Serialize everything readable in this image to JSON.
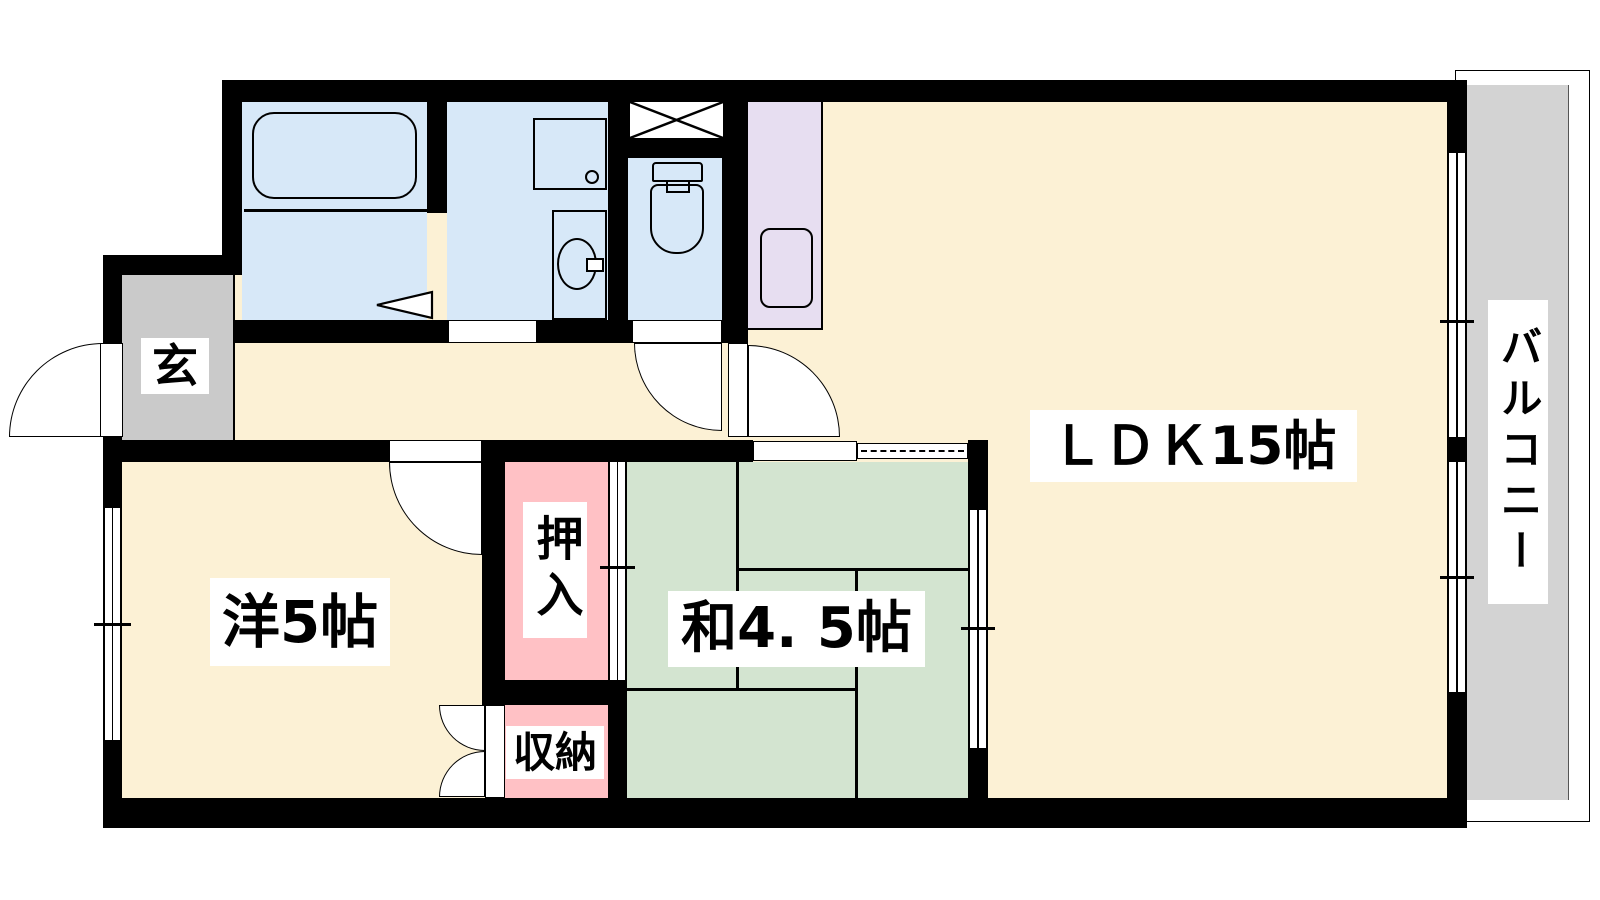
{
  "plan_type": "Japanese apartment floor plan",
  "labels": {
    "entrance": "玄",
    "western_room": "洋5帖",
    "oshiire_closet": "押入",
    "storage_closet": "収納",
    "japanese_room": "和4. 5帖",
    "ldk": "ＬＤＫ15帖",
    "balcony": "バルコニー"
  },
  "palette": {
    "wall": "#000000",
    "flooring": "#FCF1D5",
    "wet_area": "#D7E8F8",
    "kitchen_counter": "#E7DEF1",
    "closet": "#FFC1C5",
    "tatami": "#D3E4D0",
    "entrance_floor": "#CACACA",
    "balcony_floor": "#D3D3D3"
  }
}
